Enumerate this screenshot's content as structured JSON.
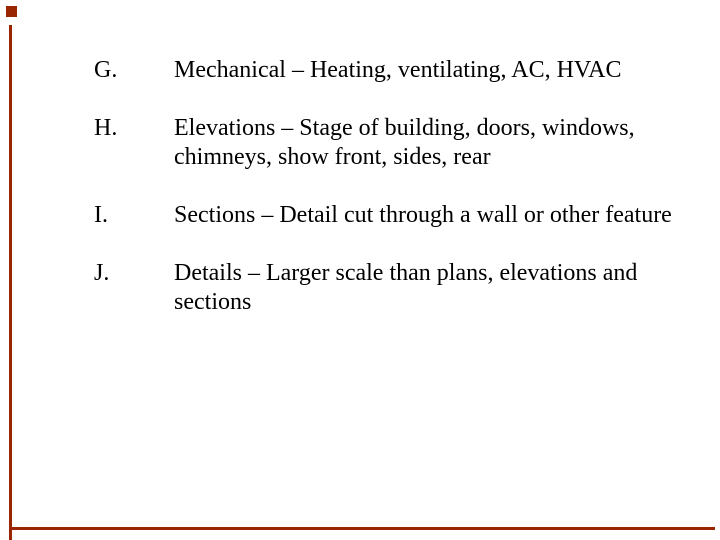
{
  "colors": {
    "accent": "#992600",
    "background": "#ffffff",
    "text": "#000000"
  },
  "list": {
    "items": [
      {
        "label": "G.",
        "lines": [
          "Mechanical – Heating, ventilating, AC, HVAC"
        ]
      },
      {
        "label": "H.",
        "lines": [
          "Elevations – Stage of building, doors, windows,",
          "chimneys, show front, sides, rear"
        ]
      },
      {
        "label": "I.",
        "lines": [
          "Sections – Detail cut through a wall or other feature"
        ]
      },
      {
        "label": "J.",
        "lines": [
          "Details – Larger scale than plans, elevations and",
          "sections"
        ]
      }
    ]
  }
}
